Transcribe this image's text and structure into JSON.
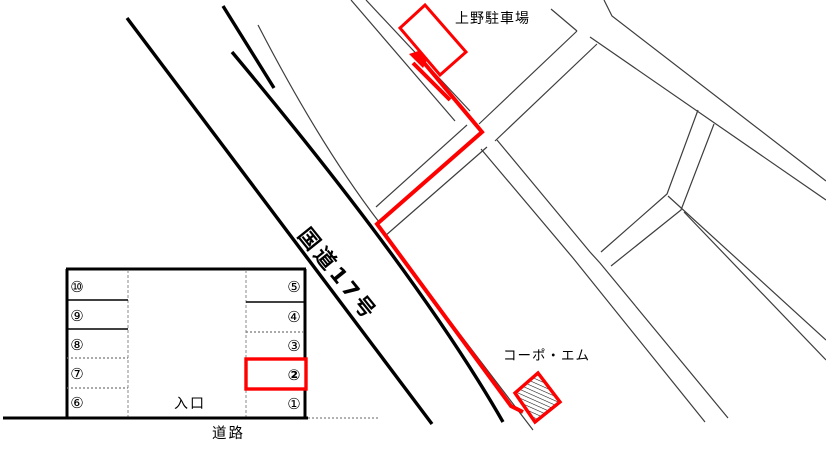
{
  "map": {
    "parking_name": "上野駐車場",
    "route_label": "国道17号",
    "building_label": "コーポ・エム"
  },
  "diagram": {
    "entrance_label": "入口",
    "road_label": "道路",
    "stalls_left": [
      "⑩",
      "⑨",
      "⑧",
      "⑦",
      "⑥"
    ],
    "stalls_right": [
      "⑤",
      "④",
      "③",
      "②",
      "①"
    ],
    "highlighted_stall": "②"
  },
  "colors": {
    "route": "#ff0000",
    "road": "#000000",
    "street": "#3d3d3d"
  }
}
